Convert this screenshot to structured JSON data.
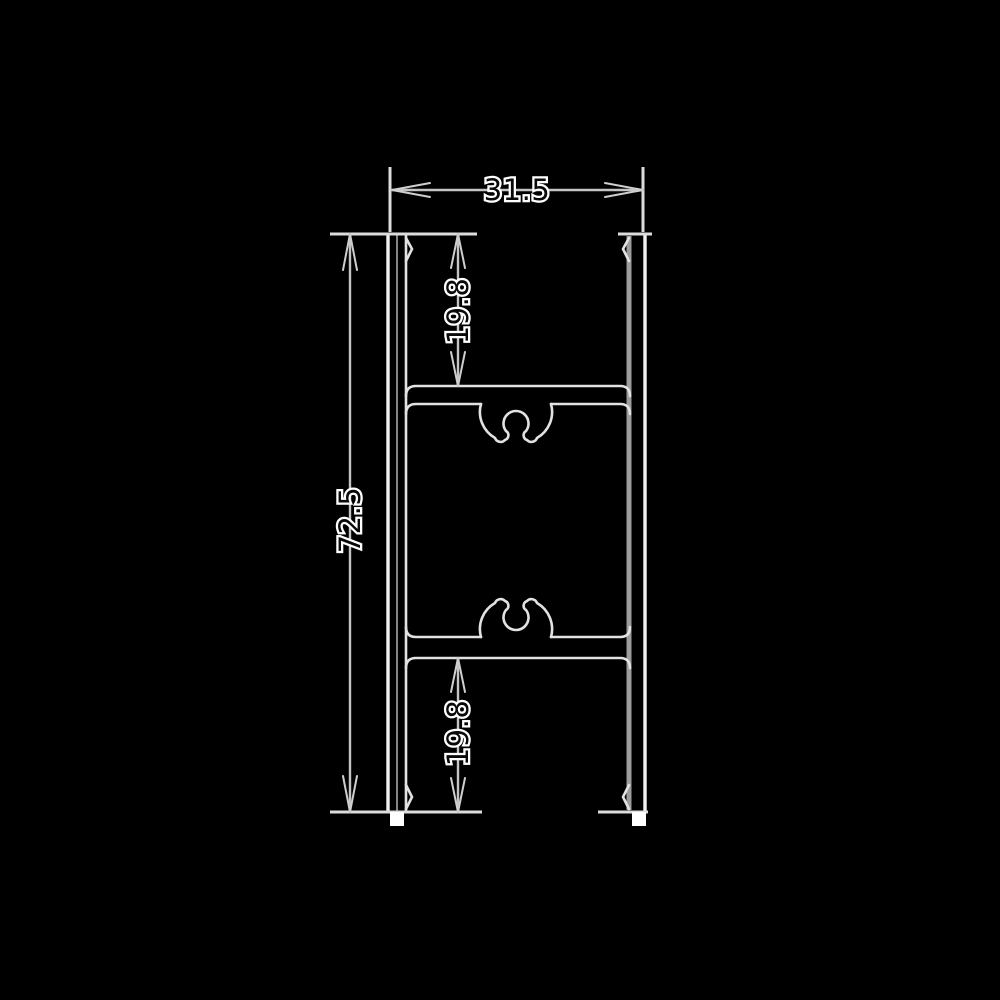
{
  "drawing": {
    "kind": "aluminium profile cross-section, dimensioned technical drawing",
    "background_color": "#000000",
    "line_color": "#e2e2e2",
    "dimension_text_fill": "#0a0a0a",
    "dimension_text_halo": "#ffffff"
  },
  "dimensions": {
    "overall_width": "31.5",
    "overall_height": "72.5",
    "top_channel_depth": "19.8",
    "bottom_channel_depth": "19.8"
  }
}
